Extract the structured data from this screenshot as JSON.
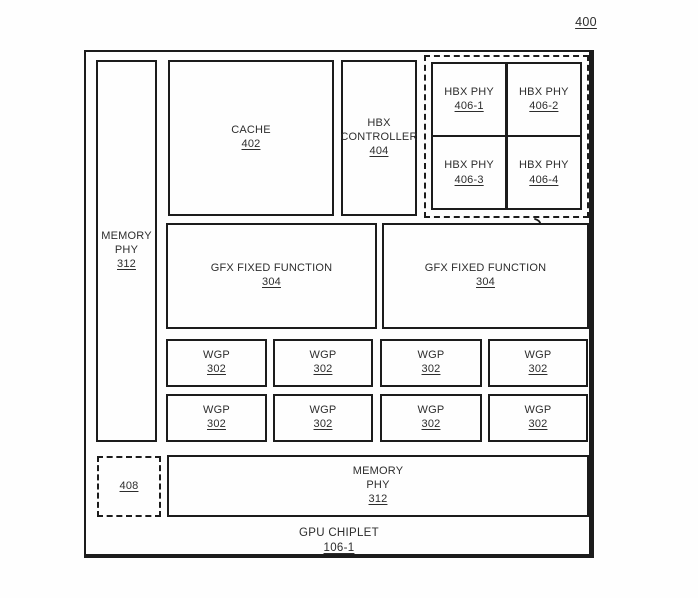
{
  "figure": {
    "number": "400",
    "caption_title": "GPU CHIPLET",
    "caption_ref": "106-1"
  },
  "colors": {
    "line": "#1c1c1c",
    "text": "#2d2d2d",
    "background": "#fefefe"
  },
  "blocks": {
    "memory_phy_left": {
      "line1": "MEMORY",
      "line2": "PHY",
      "ref": "312"
    },
    "cache": {
      "line1": "CACHE",
      "ref": "402"
    },
    "hbx_controller": {
      "line1": "HBX",
      "line2": "CONTROLLER",
      "ref": "404"
    },
    "hbx_group_callout": "118",
    "hbx_phys": [
      {
        "line1": "HBX PHY",
        "ref": "406-1"
      },
      {
        "line1": "HBX PHY",
        "ref": "406-2"
      },
      {
        "line1": "HBX PHY",
        "ref": "406-3"
      },
      {
        "line1": "HBX PHY",
        "ref": "406-4"
      }
    ],
    "gfx_left": {
      "line1": "GFX FIXED FUNCTION",
      "ref": "304"
    },
    "gfx_right": {
      "line1": "GFX FIXED FUNCTION",
      "ref": "304"
    },
    "wgps": [
      {
        "line1": "WGP",
        "ref": "302"
      },
      {
        "line1": "WGP",
        "ref": "302"
      },
      {
        "line1": "WGP",
        "ref": "302"
      },
      {
        "line1": "WGP",
        "ref": "302"
      },
      {
        "line1": "WGP",
        "ref": "302"
      },
      {
        "line1": "WGP",
        "ref": "302"
      },
      {
        "line1": "WGP",
        "ref": "302"
      },
      {
        "line1": "WGP",
        "ref": "302"
      }
    ],
    "unit_408": {
      "ref": "408"
    },
    "memory_phy_bottom": {
      "line1": "MEMORY",
      "line2": "PHY",
      "ref": "312"
    }
  }
}
